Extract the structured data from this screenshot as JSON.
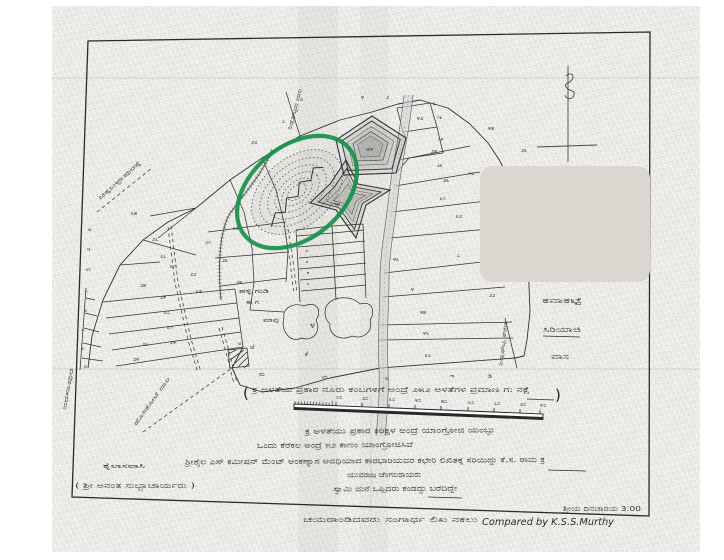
{
  "annotation": {
    "shape": "ellipse",
    "color": "#12934b"
  },
  "redaction": {
    "color": "#dad7d1"
  },
  "compass": {
    "symbol": "ಉ"
  },
  "scale": {
    "paren_open": "(",
    "paren_close": ")",
    "caption": "ಕ್ರ ಅಳತೆಯ ಪ್ರಕಾರ ನೂರು ಕಂಬಗಳಿಗೆ ಅಂದ್ರೆ ೨೫೨ ಅಳತೆಗಳ ಪ್ರಮಾಣ ಗ: ನಕ್ಷೆ",
    "ticks": [
      {
        "t": "೧೦",
        "x": 336,
        "y": 399
      },
      {
        "t": "೨೦",
        "x": 362,
        "y": 400
      },
      {
        "t": "೩೦",
        "x": 389,
        "y": 401
      },
      {
        "t": "೪೦",
        "x": 415,
        "y": 402
      },
      {
        "t": "೫೦",
        "x": 441,
        "y": 403
      },
      {
        "t": "೬೦",
        "x": 468,
        "y": 404
      },
      {
        "t": "೭೦",
        "x": 494,
        "y": 405
      },
      {
        "t": "೮೦",
        "x": 520,
        "y": 406
      },
      {
        "t": "೯೦",
        "x": 540,
        "y": 407
      }
    ]
  },
  "notes": {
    "lines": [
      "ಕ್ರ ಅಳತೆಯು ಪ್ರಕಾರ ಕಿರಿಕ್ಷಳ ಅಂದ್ರೆ ಯಾಂಗ್ರೋಜಿ ಯಂಬ್ಳು",
      "ಒಂದು ಕೆರೆಕಲ ಅಂದ್ರೆ ೫೨ ಕಾಣಂ ಯಾಂಗ್ರೋಜಿಸಿವೆ",
      "ಶ್ರೀಶೈಲ ಎಸ್ ಕಮೀಷನ್ ಮೆಂಟ್ ಅಂಕಣ್ಯಾನ ಅವಧಿಯಾದ ಕಾರಭಾರಿಯವರ ಕಛೇರಿ ಲಿಖಿತಕ್ಕೆ ಸರಿಯಿದ್ದು ಕೆ.ಸ. ರಾಮ ಕ್ರ",
      "ಯುವರಾಜ ಚೆಂಗಲರಾಯರು",
      "ಸ್ವಾಮಿ ಮನೆ ಒಪ್ಪಿದರು ಕಂಡದ್ದು ಬರೆದಿದ್ದೇ"
    ]
  },
  "signatures": {
    "left_line1": "ಕೈಲಾಸವಾಸಿ",
    "left_line2": "( ಶ್ರೀ ಅನಂತ ಸುಬ್ಬಾಚಾರ್ಯರು )",
    "right_top": "ಶ್ರೀಯ ದಿನಚಾರಯ 3:00",
    "bottom_kannada": "ಚಯರಾಂಡಿದವರು ಸಂಗಾರ್ಥ ಲಿಖ ನಕಲು",
    "compared_by": "Compared by K.S.S.Murthy"
  },
  "map": {
    "labels": [
      {
        "t": "ಚಿಕ್ಕಬಳ್ಳಾಪುರಕ್ಕೆ",
        "x": 100,
        "y": 200,
        "r": -42,
        "s": 5.5,
        "tl": 55
      },
      {
        "t": "ಶಿಡ್ಲಘಟ್ಟದ ದಾರಿ",
        "x": 291,
        "y": 130,
        "r": -75,
        "s": 5.5,
        "tl": 42
      },
      {
        "t": "ಹೊಸಕೋಟೆ ದಾರಿ",
        "x": 136,
        "y": 426,
        "r": -54,
        "s": 5.5,
        "tl": 58
      },
      {
        "t": "ನರಸಾಪುರ",
        "x": 66,
        "y": 410,
        "r": -80,
        "s": 5.5,
        "tl": 42
      },
      {
        "t": "ಶಿಡ್ಲಘಟ್ಟ ಕೆರೆಗೆ",
        "x": 502,
        "y": 366,
        "r": -83,
        "s": 5,
        "tl": 44
      },
      {
        "t": "ಕನಾಕಟ್ಟೆ",
        "x": 542,
        "y": 303,
        "s": 7,
        "tl": 40
      },
      {
        "t": "ಸಿರಿಯಾಜಿ",
        "x": 543,
        "y": 332,
        "s": 7,
        "tl": 38
      },
      {
        "t": "ವಾಸ",
        "x": 551,
        "y": 359,
        "s": 7,
        "tl": 18
      },
      {
        "t": "ಹಳ್ಳಿ ಗುಡಿ",
        "x": 239,
        "y": 293,
        "s": 6,
        "tl": 30
      },
      {
        "t": "ಈ ಗ",
        "x": 246,
        "y": 304,
        "s": 6,
        "tl": 13
      },
      {
        "t": "ಮಾವು",
        "x": 263,
        "y": 322,
        "s": 6,
        "tl": 16
      },
      {
        "t": "ಕೆ",
        "x": 305,
        "y": 356,
        "s": 6
      },
      {
        "t": "ಜೆ",
        "x": 250,
        "y": 349,
        "s": 6
      },
      {
        "t": "ಮ",
        "x": 259,
        "y": 376,
        "s": 6
      }
    ],
    "plot_numbers": [
      {
        "t": "೮",
        "x": 300,
        "y": 101
      },
      {
        "t": "೪",
        "x": 361,
        "y": 99
      },
      {
        "t": "೨",
        "x": 386,
        "y": 99
      },
      {
        "t": "೬",
        "x": 433,
        "y": 105
      },
      {
        "t": "೭",
        "x": 282,
        "y": 123
      },
      {
        "t": "೨೮",
        "x": 251,
        "y": 144
      },
      {
        "t": "೩೫",
        "x": 131,
        "y": 215
      },
      {
        "t": "೨೬",
        "x": 152,
        "y": 241
      },
      {
        "t": "೨೭",
        "x": 160,
        "y": 258
      },
      {
        "t": "೩೧",
        "x": 170,
        "y": 268
      },
      {
        "t": "೨೫",
        "x": 140,
        "y": 287
      },
      {
        "t": "೨೨",
        "x": 190,
        "y": 276
      },
      {
        "t": "೨೧",
        "x": 205,
        "y": 244
      },
      {
        "t": "೨೩",
        "x": 222,
        "y": 262
      },
      {
        "t": "೨೪",
        "x": 236,
        "y": 284
      },
      {
        "t": "೩೪",
        "x": 233,
        "y": 230
      },
      {
        "t": "ಅ",
        "x": 88,
        "y": 231,
        "s": 5
      },
      {
        "t": "ಇ",
        "x": 87,
        "y": 251,
        "s": 5
      },
      {
        "t": "ಉ",
        "x": 86,
        "y": 271,
        "s": 5
      },
      {
        "t": "೧",
        "x": 85,
        "y": 293,
        "s": 5
      },
      {
        "t": "೨",
        "x": 84,
        "y": 312,
        "s": 5
      },
      {
        "t": "೩",
        "x": 82,
        "y": 331,
        "s": 5
      },
      {
        "t": "೪",
        "x": 81,
        "y": 350,
        "s": 5
      },
      {
        "t": "೮",
        "x": 84,
        "y": 368,
        "s": 5
      },
      {
        "t": "೨೯",
        "x": 160,
        "y": 299
      },
      {
        "t": "೩೦",
        "x": 164,
        "y": 314
      },
      {
        "t": "೩೧",
        "x": 167,
        "y": 329
      },
      {
        "t": "೨೪",
        "x": 170,
        "y": 344
      },
      {
        "t": "೨೩",
        "x": 142,
        "y": 346
      },
      {
        "t": "೨೪",
        "x": 133,
        "y": 361
      },
      {
        "t": "೩೪",
        "x": 196,
        "y": 293
      },
      {
        "t": "ಅ",
        "x": 238,
        "y": 345,
        "s": 5
      },
      {
        "t": "ಉ",
        "x": 322,
        "y": 379,
        "s": 6
      },
      {
        "t": "ಲ",
        "x": 385,
        "y": 380,
        "s": 6
      },
      {
        "t": "ಇ",
        "x": 450,
        "y": 378,
        "s": 6
      },
      {
        "t": "ಡಿ",
        "x": 488,
        "y": 378,
        "s": 6
      },
      {
        "t": "ಳ",
        "x": 310,
        "y": 328,
        "s": 9
      },
      {
        "t": "ಅ೪",
        "x": 366,
        "y": 151,
        "s": 6
      },
      {
        "t": "ಇ೫",
        "x": 333,
        "y": 206,
        "s": 6
      },
      {
        "t": "೪೩",
        "x": 393,
        "y": 261
      },
      {
        "t": "೪",
        "x": 411,
        "y": 291
      },
      {
        "t": "೪೫",
        "x": 420,
        "y": 314
      },
      {
        "t": "೪೬",
        "x": 423,
        "y": 335
      },
      {
        "t": "೩೬",
        "x": 425,
        "y": 357
      },
      {
        "t": "೭",
        "x": 457,
        "y": 257
      },
      {
        "t": "೨೨",
        "x": 489,
        "y": 297
      },
      {
        "t": "೩೮",
        "x": 456,
        "y": 218
      },
      {
        "t": "೨೫",
        "x": 431,
        "y": 153
      },
      {
        "t": "೨೩",
        "x": 443,
        "y": 182
      },
      {
        "t": "೧೮",
        "x": 468,
        "y": 175
      },
      {
        "t": "೧೩",
        "x": 437,
        "y": 119,
        "s": 5
      },
      {
        "t": "೧೯",
        "x": 438,
        "y": 141,
        "s": 5
      },
      {
        "t": "೨೮",
        "x": 437,
        "y": 167,
        "s": 5
      },
      {
        "t": "೩೧",
        "x": 440,
        "y": 200,
        "s": 5
      },
      {
        "t": "೪೨",
        "x": 417,
        "y": 120
      },
      {
        "t": "೨೩",
        "x": 521,
        "y": 152
      },
      {
        "t": "೪೫",
        "x": 488,
        "y": 130
      },
      {
        "t": "೨",
        "x": 305,
        "y": 241,
        "s": 4
      },
      {
        "t": "೩",
        "x": 306,
        "y": 252,
        "s": 4
      },
      {
        "t": "೪",
        "x": 306,
        "y": 263,
        "s": 4
      },
      {
        "t": "೫",
        "x": 307,
        "y": 274,
        "s": 4
      },
      {
        "t": "೬",
        "x": 307,
        "y": 285,
        "s": 4
      }
    ]
  }
}
